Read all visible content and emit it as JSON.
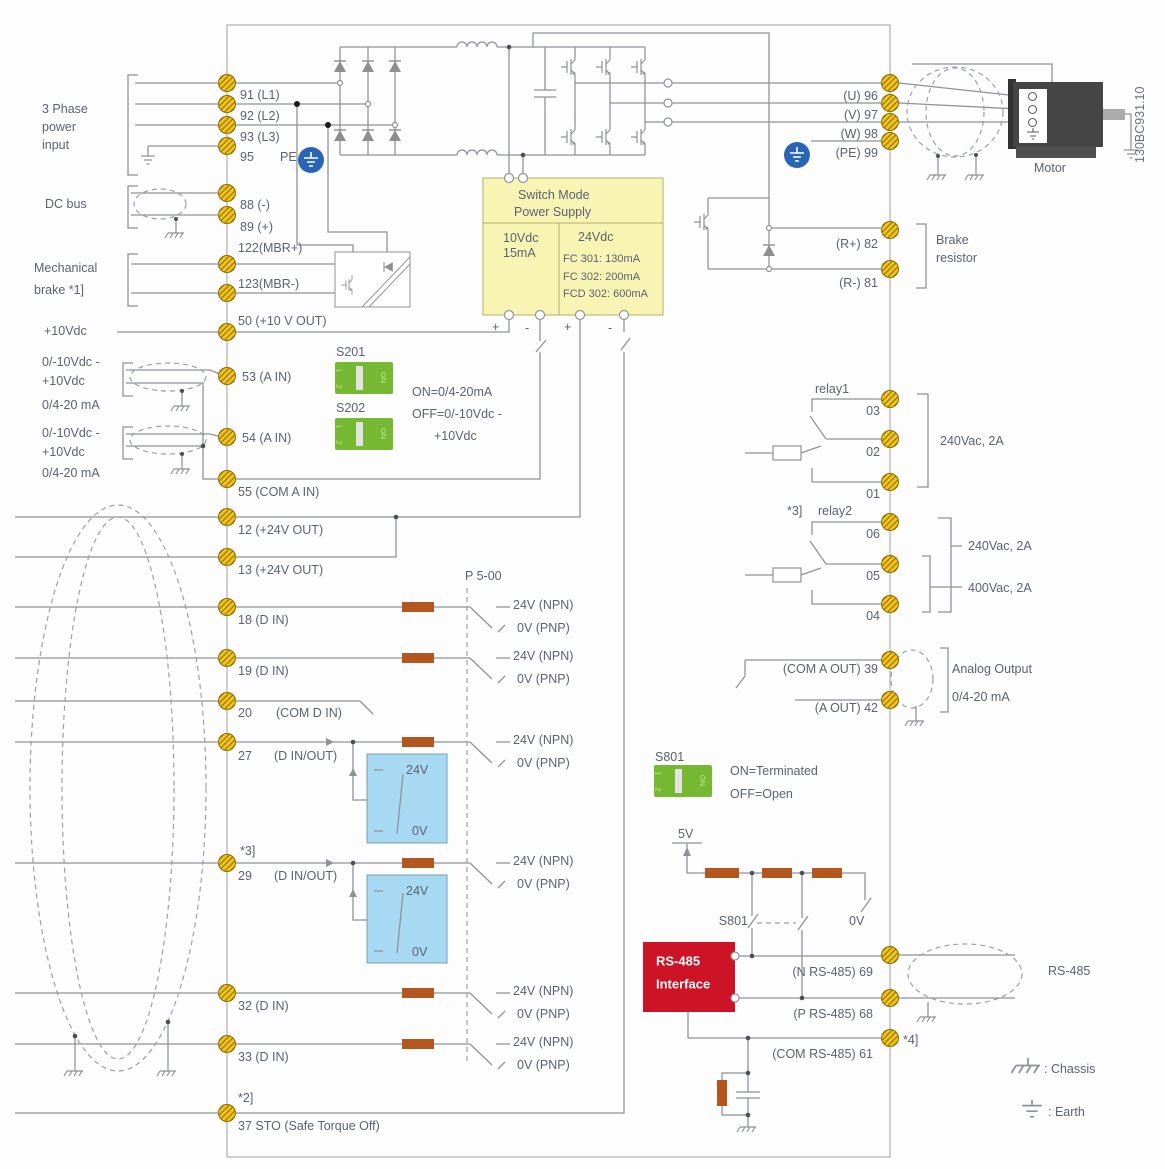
{
  "meta": {
    "code": "130BC931.10"
  },
  "left": {
    "power_input": [
      "3 Phase",
      "power",
      "input"
    ],
    "dc_bus": "DC bus",
    "mech_brake": [
      "Mechanical",
      "brake *1]"
    ],
    "plus10v": "+10Vdc",
    "ain_range": [
      "0/-10Vdc -",
      "+10Vdc",
      "0/4-20 mA"
    ],
    "t": {
      "91": "91 (L1)",
      "92": "92 (L2)",
      "93": "93 (L3)",
      "95": "95",
      "pe": "PE",
      "88": "88 (-)",
      "89": "89 (+)",
      "122": "122(MBR+)",
      "123": "123(MBR-)",
      "50": "50 (+10 V OUT)",
      "53": "53 (A IN)",
      "54": "54 (A IN)",
      "55": "55 (COM A IN)",
      "12": "12 (+24V OUT)",
      "13": "13 (+24V OUT)",
      "18": "18 (D IN)",
      "19": "19 (D IN)",
      "20": "20",
      "20com": "(COM D IN)",
      "27": "27",
      "27io": "(D IN/OUT)",
      "29": "29",
      "29io": "(D IN/OUT)",
      "32": "32 (D IN)",
      "33": "33 (D IN)",
      "37": "37 STO (Safe Torque Off)",
      "note2": "*2]",
      "note3": "*3]"
    }
  },
  "smps": {
    "title1": "Switch Mode",
    "title2": "Power Supply",
    "v10": "10Vdc",
    "i10": "15mA",
    "v24": "24Vdc",
    "fc301": "FC 301: 130mA",
    "fc302": "FC 302: 200mA",
    "fcd302": "FCD 302: 600mA",
    "plus": "+",
    "minus": "-"
  },
  "dip": {
    "s201": "S201",
    "s202": "S202",
    "s801": "S801",
    "on": "ON",
    "p1": "1",
    "p2": "2",
    "s20x_on": "ON=0/4-20mA",
    "s20x_off1": "OFF=0/-10Vdc -",
    "s20x_off2": "+10Vdc",
    "s801_on": "ON=Terminated",
    "s801_off": "OFF=Open"
  },
  "digital": {
    "p500": "P 5-00",
    "npn": "24V (NPN)",
    "pnp": "0V (PNP)",
    "v24": "24V",
    "v0": "0V"
  },
  "serial": {
    "v5": "5V",
    "s801": "S801",
    "v0": "0V",
    "box1": "RS-485",
    "box2": "Interface",
    "t69": "(N RS-485) 69",
    "t68": "(P RS-485) 68",
    "t61": "(COM RS-485) 61",
    "note4": "*4]",
    "cable": "RS-485"
  },
  "right": {
    "t96": "(U) 96",
    "t97": "(V) 97",
    "t98": "(W) 98",
    "t99": "(PE) 99",
    "motor": "Motor",
    "t82": "(R+) 82",
    "t81": "(R-) 81",
    "brake": [
      "Brake",
      "resistor"
    ],
    "relay1": "relay1",
    "relay2_note": "*3]",
    "relay2": "relay2",
    "r03": "03",
    "r02": "02",
    "r01": "01",
    "r06": "06",
    "r05": "05",
    "r04": "04",
    "rating240": "240Vac, 2A",
    "rating400": "400Vac, 2A",
    "t39": "(COM A OUT) 39",
    "t42": "(A OUT) 42",
    "aout": [
      "Analog Output",
      "0/4-20 mA"
    ]
  },
  "legend": {
    "chassis": ": Chassis",
    "earth": ": Earth"
  },
  "colors": {
    "wire": "#8f9399",
    "text": "#5b6270",
    "terminal": "#f2c51d",
    "pe_blue": "#2a65b5",
    "smps_yellow": "#f8f4b4",
    "dip_green": "#76b832",
    "io_blue": "#a8d9f2",
    "box_red": "#cc1426",
    "resistor": "#b4571e"
  }
}
